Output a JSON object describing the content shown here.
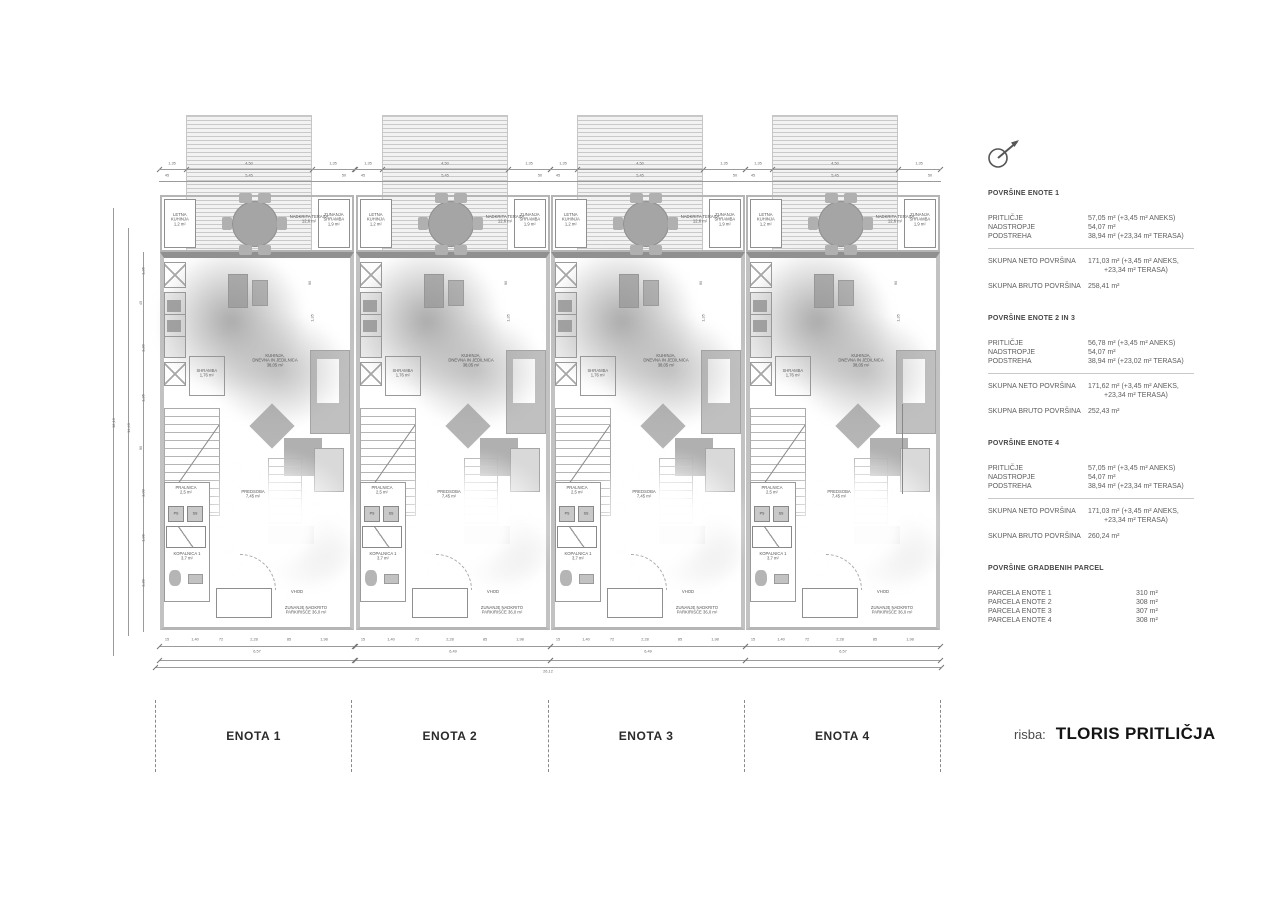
{
  "title_block": {
    "prefix": "risba:",
    "title": "TLORIS PRITLIČJA"
  },
  "icons": {
    "compass": "north-arrow"
  },
  "units": [
    {
      "name": "ENOTA 1",
      "width_label": "6,57"
    },
    {
      "name": "ENOTA 2",
      "width_label": "6,49"
    },
    {
      "name": "ENOTA 3",
      "width_label": "6,49"
    },
    {
      "name": "ENOTA 4",
      "width_label": "6,57"
    }
  ],
  "unit_labels": {
    "letna_kuhinja": [
      "LETNA",
      "KUHINJA",
      "1,2 m²"
    ],
    "zunanja_shramba": [
      "ZUNANJA",
      "SHRAMBA",
      "1,9 m²"
    ],
    "terasa": [
      "NADKRITA TERASA",
      "12,6 m²"
    ],
    "shramba": [
      "SHRAMBA",
      "1,76 m²"
    ],
    "living": [
      "KUHINJA,",
      "DNEVNA IN JEDILNICA",
      "38,05 m²"
    ],
    "pralnica": [
      "PRALNICA",
      "2,5 m²"
    ],
    "ps": "PS",
    "ss": "SS",
    "predsoba": [
      "PREDSOBA",
      "7,45 m²"
    ],
    "kopalnica": [
      "KOPALNICA 1",
      "3,7 m²"
    ],
    "vhod": "VHOD",
    "parking": [
      "ZUNANJE NADKRITO",
      "PARKIRIŠČE 36,0 m²"
    ]
  },
  "dims": {
    "top1": [
      "1,35",
      "4,50",
      "1,35"
    ],
    "top2": [
      "45",
      "5,45",
      "50"
    ],
    "bottom_fine": [
      "15",
      "1,40",
      "72",
      "2,28",
      "85",
      "1,98"
    ],
    "left_chain": [
      "1,35",
      "45",
      "3,30",
      "1,35",
      "90",
      "3,09",
      "1,98",
      "2,39"
    ],
    "left_mid": "14,40",
    "left_total": "16,10",
    "total_width": "26,12",
    "inner": [
      "90",
      "1,35"
    ]
  },
  "area_blocks": [
    {
      "heading": "POVRŠINE ENOTE 1",
      "rows": [
        {
          "label": "PRITLIČJE",
          "value": "57,05 m² (+3,45 m² ANEKS)"
        },
        {
          "label": "NADSTROPJE",
          "value": "54,07 m²"
        },
        {
          "label": "PODSTREHA",
          "value": "38,94 m² (+23,34 m² TERASA)"
        }
      ],
      "totals": [
        {
          "label": "SKUPNA NETO POVRŠINA",
          "value": "171,03 m² (+3,45 m² ANEKS,",
          "value2": "+23,34 m² TERASA)"
        },
        {
          "label": "SKUPNA BRUTO POVRŠINA",
          "value": "258,41 m²",
          "value2": ""
        }
      ]
    },
    {
      "heading": "POVRŠINE ENOTE 2 IN 3",
      "rows": [
        {
          "label": "PRITLIČJE",
          "value": "56,78 m² (+3,45 m² ANEKS)"
        },
        {
          "label": "NADSTROPJE",
          "value": "54,07 m²"
        },
        {
          "label": "PODSTREHA",
          "value": "38,94 m² (+23,02 m² TERASA)"
        }
      ],
      "totals": [
        {
          "label": "SKUPNA NETO POVRŠINA",
          "value": "171,62 m² (+3,45 m² ANEKS,",
          "value2": "+23,34 m² TERASA)"
        },
        {
          "label": "SKUPNA BRUTO POVRŠINA",
          "value": "252,43 m²",
          "value2": ""
        }
      ]
    },
    {
      "heading": "POVRŠINE ENOTE 4",
      "rows": [
        {
          "label": "PRITLIČJE",
          "value": "57,05 m² (+3,45 m² ANEKS)"
        },
        {
          "label": "NADSTROPJE",
          "value": "54,07 m²"
        },
        {
          "label": "PODSTREHA",
          "value": "38,94 m² (+23,34 m² TERASA)"
        }
      ],
      "totals": [
        {
          "label": "SKUPNA NETO POVRŠINA",
          "value": "171,03 m² (+3,45 m² ANEKS,",
          "value2": "+23,34 m² TERASA)"
        },
        {
          "label": "SKUPNA BRUTO POVRŠINA",
          "value": "260,24 m²",
          "value2": ""
        }
      ]
    }
  ],
  "parcel_block": {
    "heading": "POVRŠINE GRADBENIH PARCEL",
    "rows": [
      {
        "label": "PARCELA ENOTE 1",
        "value": "310 m²"
      },
      {
        "label": "PARCELA ENOTE 2",
        "value": "308 m²"
      },
      {
        "label": "PARCELA ENOTE 3",
        "value": "307 m²"
      },
      {
        "label": "PARCELA ENOTE 4",
        "value": "308 m²"
      }
    ]
  }
}
